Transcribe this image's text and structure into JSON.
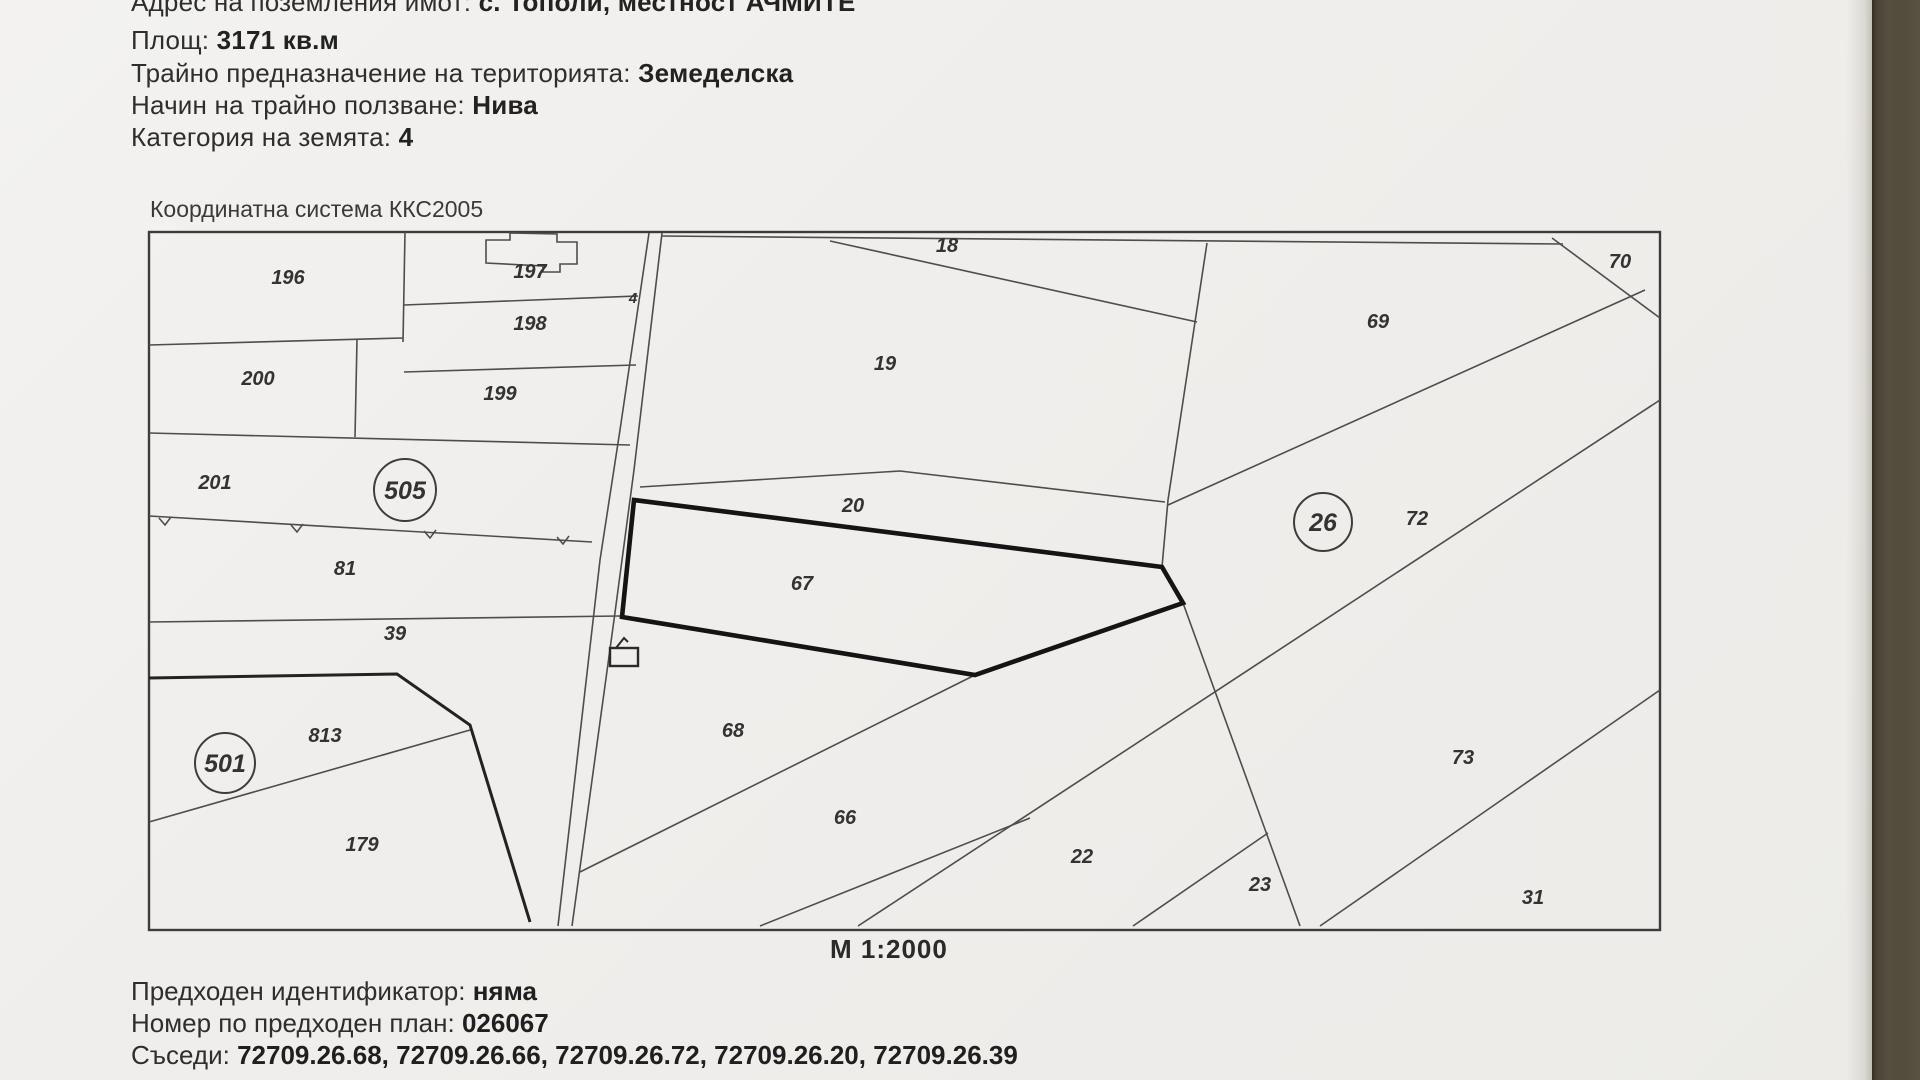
{
  "document": {
    "header_rows": [
      {
        "label": "Адрес на поземления имот:",
        "value": "с. Тополи, местност АЧМИТЕ"
      },
      {
        "label": "Площ:",
        "value": "3171 кв.м"
      },
      {
        "label": "Трайно предназначение на територията:",
        "value": "Земеделска"
      },
      {
        "label": "Начин на трайно ползване:",
        "value": "Нива"
      },
      {
        "label": "Категория на земята:",
        "value": "4"
      }
    ],
    "coordinate_system": "Координатна система ККС2005",
    "scale": "М 1:2000",
    "footer_rows": [
      {
        "label": "Предходен идентификатор:",
        "value": "няма"
      },
      {
        "label": "Номер по предходен план:",
        "value": "026067"
      },
      {
        "label": "Съседи:",
        "value": "72709.26.68, 72709.26.66, 72709.26.72, 72709.26.20, 72709.26.39"
      }
    ]
  },
  "map": {
    "subject_parcel": "67",
    "parcel_labels": [
      {
        "text": "196",
        "x": 288,
        "y": 284
      },
      {
        "text": "197",
        "x": 530,
        "y": 278
      },
      {
        "text": "198",
        "x": 530,
        "y": 330
      },
      {
        "text": "200",
        "x": 258,
        "y": 385
      },
      {
        "text": "199",
        "x": 500,
        "y": 400
      },
      {
        "text": "201",
        "x": 215,
        "y": 489
      },
      {
        "text": "81",
        "x": 345,
        "y": 575
      },
      {
        "text": "39",
        "x": 395,
        "y": 640
      },
      {
        "text": "813",
        "x": 325,
        "y": 742
      },
      {
        "text": "179",
        "x": 362,
        "y": 851
      },
      {
        "text": "4",
        "x": 633,
        "y": 303,
        "small": true
      },
      {
        "text": "18",
        "x": 947,
        "y": 252
      },
      {
        "text": "19",
        "x": 885,
        "y": 370
      },
      {
        "text": "20",
        "x": 853,
        "y": 512
      },
      {
        "text": "67",
        "x": 802,
        "y": 590
      },
      {
        "text": "68",
        "x": 733,
        "y": 737
      },
      {
        "text": "66",
        "x": 845,
        "y": 824
      },
      {
        "text": "22",
        "x": 1082,
        "y": 863
      },
      {
        "text": "23",
        "x": 1260,
        "y": 891
      },
      {
        "text": "69",
        "x": 1378,
        "y": 328
      },
      {
        "text": "70",
        "x": 1620,
        "y": 268
      },
      {
        "text": "72",
        "x": 1417,
        "y": 525
      },
      {
        "text": "73",
        "x": 1463,
        "y": 764
      },
      {
        "text": "31",
        "x": 1533,
        "y": 904
      }
    ],
    "circled_labels": [
      {
        "text": "505",
        "x": 405,
        "y": 490,
        "r": 31
      },
      {
        "text": "26",
        "x": 1323,
        "y": 522,
        "r": 29
      },
      {
        "text": "501",
        "x": 225,
        "y": 763,
        "r": 30
      }
    ]
  }
}
